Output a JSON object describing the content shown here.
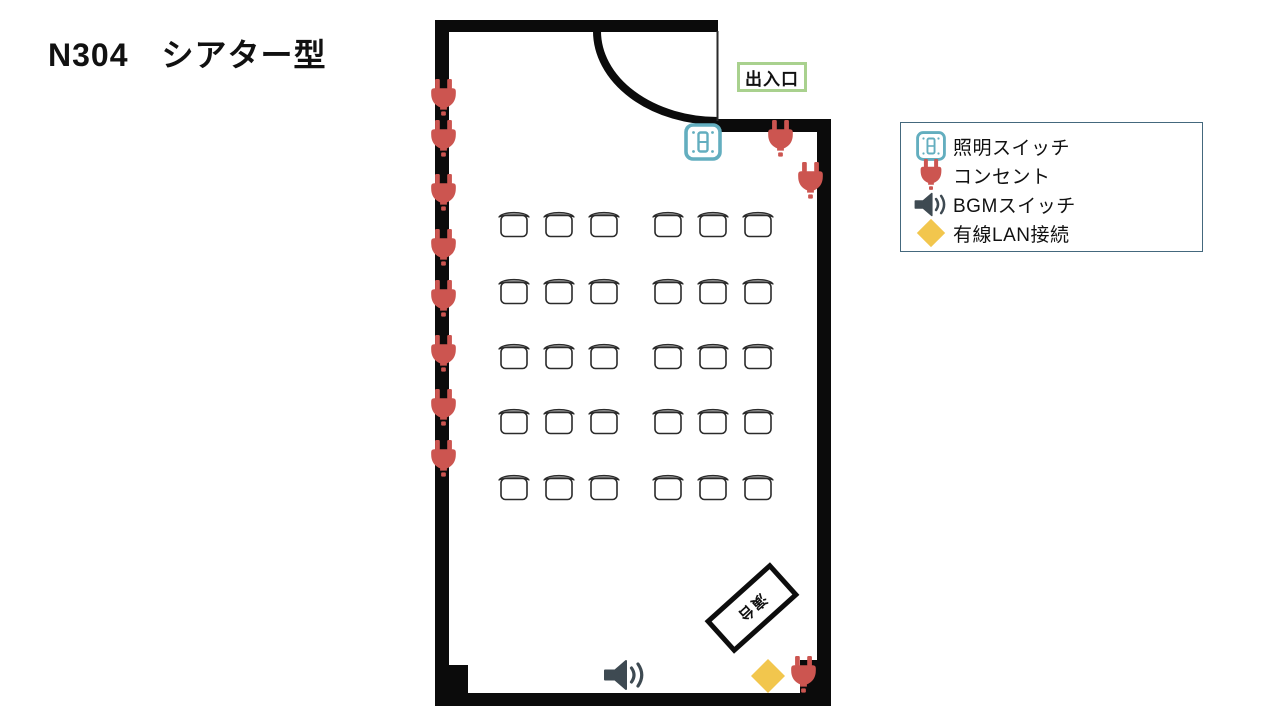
{
  "title": "N304　シアター型",
  "room": {
    "door_label": "出入口",
    "podium_label": "演台"
  },
  "legend": {
    "items": [
      {
        "icon": "light-switch-icon",
        "label": "照明スイッチ"
      },
      {
        "icon": "outlet-icon",
        "label": "コンセント"
      },
      {
        "icon": "bgm-switch-icon",
        "label": "BGMスイッチ"
      },
      {
        "icon": "lan-icon",
        "label": "有線LAN接続"
      }
    ]
  },
  "colors": {
    "wall_black": "#0b0b0b",
    "door_leaf": "#2a2a2a",
    "outlet_red": "#CC5550",
    "switch_teal": "#63AEBF",
    "speaker_dark": "#3E4A52",
    "lan_yellow": "#F2C64D",
    "door_label_green": "#A9D18E",
    "legend_border_blue": "#44687D",
    "chair_back_gray": "#9E9E9E",
    "chair_stroke": "#2b2b2b"
  },
  "floorplan": {
    "chair_rows_y": [
      208,
      275,
      340,
      405,
      471
    ],
    "chair_cols_x": [
      497,
      542,
      587,
      651,
      696,
      741
    ],
    "left_wall_outlets_x": 443,
    "left_wall_outlets_y": [
      98,
      139,
      193,
      248,
      299,
      354,
      408,
      459
    ],
    "free_outlets": [
      {
        "x": 780,
        "y": 139
      },
      {
        "x": 810,
        "y": 181
      },
      {
        "x": 803,
        "y": 675
      }
    ],
    "light_switch": {
      "x": 703,
      "y": 142
    },
    "bgm_switch": {
      "x": 625,
      "y": 675
    },
    "lan_port": {
      "x": 768,
      "y": 676
    },
    "podium": {
      "x": 752,
      "y": 608,
      "rotation_deg": -42
    }
  }
}
